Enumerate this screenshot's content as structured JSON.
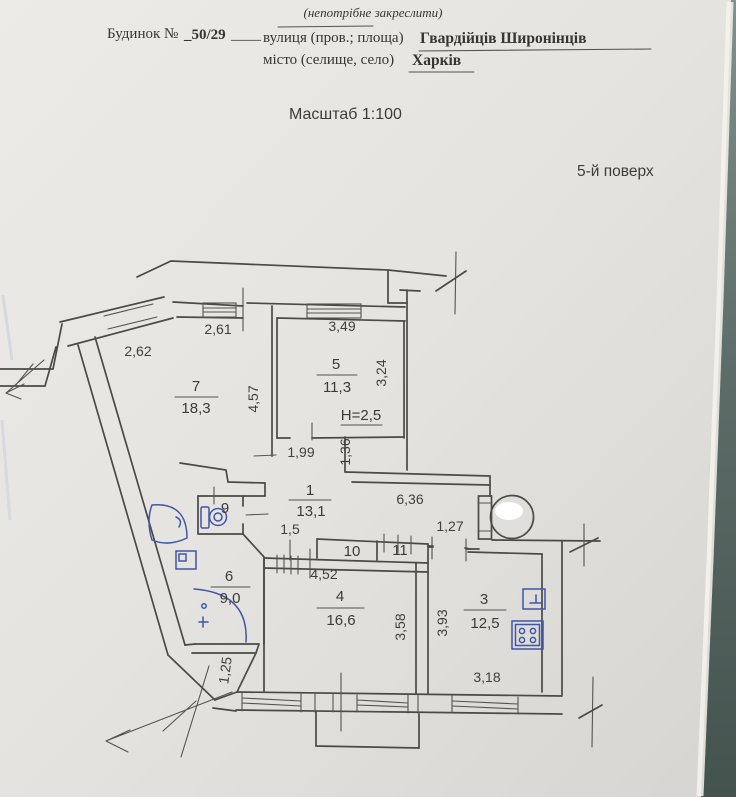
{
  "header": {
    "note": "(непотрібне закреслити)",
    "house_label": "Будинок №",
    "house_number": "_50/29",
    "underscores": "____",
    "street_label": "вулиця (пров.; площа)",
    "street_value": "Гвардійців Широнінців",
    "city_label": "місто (селище, село)",
    "city_value": "Харків",
    "scale_label": "Масштаб 1:100",
    "floor_label": "5-й поверх"
  },
  "rooms": {
    "r7": {
      "num": "7",
      "area": "18,3"
    },
    "r5": {
      "num": "5",
      "area": "11,3",
      "ceiling": "H=2,5"
    },
    "r1": {
      "num": "1",
      "area": "13,1"
    },
    "r6": {
      "num": "6",
      "area": "9,0"
    },
    "r4": {
      "num": "4",
      "area": "16,6"
    },
    "r3": {
      "num": "3",
      "area": "12,5"
    },
    "wc": {
      "num": "9"
    },
    "c10": {
      "num": "10"
    },
    "c11": {
      "num": "11"
    }
  },
  "dims": {
    "d262": "2,62",
    "d261": "2,61",
    "d349": "3,49",
    "d324": "3,24",
    "d457": "4,57",
    "d199": "1,99",
    "d136": "1,36",
    "d636": "6,36",
    "d127": "1,27",
    "d15": "1,5",
    "d452": "4,52",
    "d358": "3,58",
    "d393": "3,93",
    "d318": "3,18",
    "d125": "1,25"
  },
  "colors": {
    "paper": "#e7e5e1",
    "ink": "#4b4a44",
    "pen_blue": "#3f57a8",
    "backdrop": "#5e6d69"
  }
}
